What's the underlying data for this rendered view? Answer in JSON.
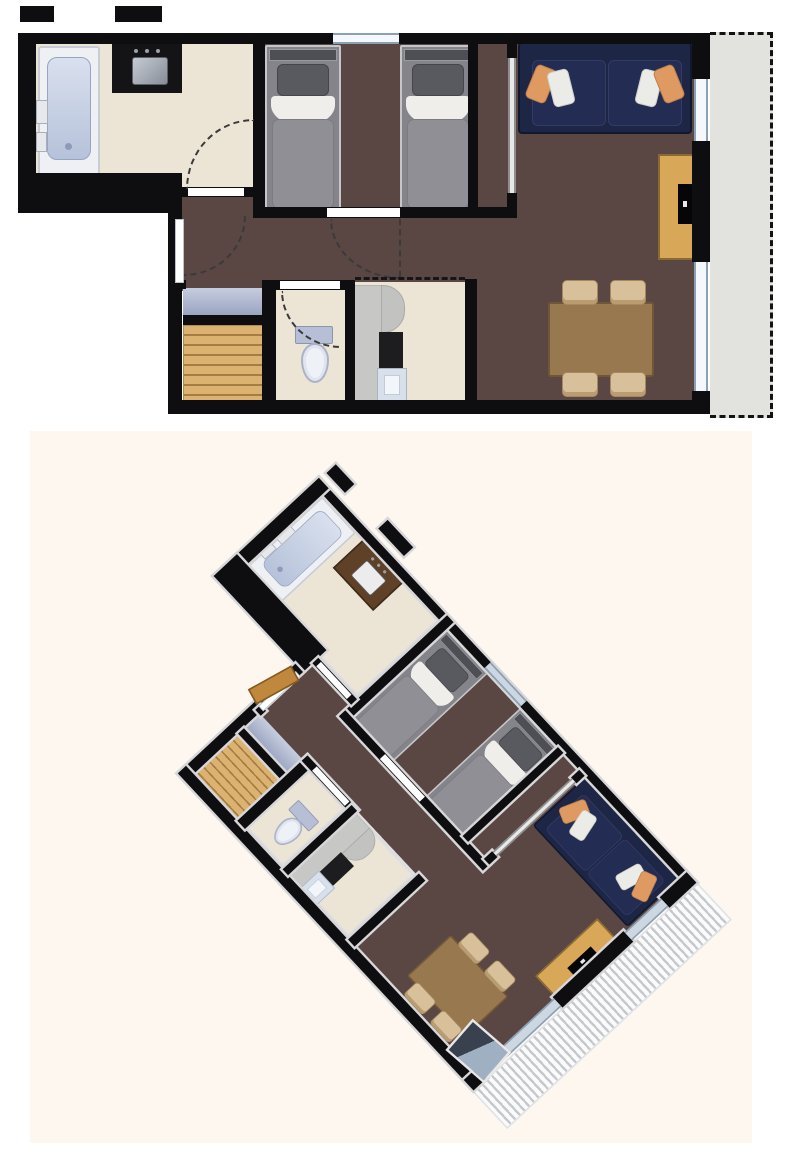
{
  "document": {
    "kind": "apartment floor plan, two views",
    "views": {
      "top": {
        "type": "2D top-down plan"
      },
      "bottom": {
        "type": "3D rotated dollhouse plan",
        "rotation_deg": 47,
        "background": "#fdf7ef",
        "balcony_finish": "white plank decking stripes"
      }
    }
  },
  "palette": {
    "background": "#ffffff",
    "backdrop3d": "#fdf7ef",
    "wall": "#0e0e10",
    "tile": "#ece5d6",
    "carpet": "#5a4743",
    "balcony": "#e2e2df",
    "mat": "#b0b9d2",
    "stairs_wood": "#dcb271",
    "entry_door_wood": "#c0883c",
    "sofa_navy": "#1e2646",
    "pillow_orange": "#df9a62",
    "pillow_white": "#ebebe8",
    "bed_duvet_gray": "#8f8f95",
    "bed_sheet_white": "#efeeea",
    "table_wood": "#98794f",
    "chair_beige": "#d8c09a",
    "sideboard_wood": "#d8a757",
    "tub_blue": "#c3cede",
    "vanity_black": "#141417",
    "window_frame": "#8aa0b4"
  },
  "rooms": {
    "bathroom": {
      "label": "Bathroom",
      "floor_material": "beige tile",
      "furniture": [
        "bathtub",
        "black vanity with sink"
      ],
      "features": [
        "door swing arc"
      ]
    },
    "bedroom": {
      "label": "Bedroom",
      "floor_material": "dark brown carpet",
      "furniture": [
        "single bed",
        "single bed"
      ],
      "features": [
        "window in top wall",
        "door to hallway"
      ]
    },
    "living_room": {
      "label": "Living room / dining",
      "floor_material": "dark brown carpet",
      "furniture": [
        "navy sofa with orange and white cushions",
        "wooden TV sideboard with TV",
        "wooden dining table",
        "4 beige chairs"
      ],
      "features": [
        "two windows to balcony",
        "glazed partition to bedroom nook"
      ]
    },
    "hallway": {
      "label": "Hallway",
      "floor_material": "dark brown carpet",
      "furniture": [],
      "features": [
        "apartment entry door with swing arc"
      ]
    },
    "entry": {
      "label": "Entry / stairs",
      "floor_material": "wood planks",
      "furniture": [
        "doormat",
        "wooden stairs"
      ],
      "features": []
    },
    "wc": {
      "label": "WC",
      "floor_material": "beige tile",
      "furniture": [
        "toilet"
      ],
      "features": [
        "door swing arc"
      ]
    },
    "kitchen": {
      "label": "Kitchen",
      "floor_material": "beige tile",
      "furniture": [
        "counter run",
        "black cooktop",
        "sink"
      ],
      "features": [
        "open side marked with dashed line"
      ]
    },
    "balcony": {
      "label": "Balcony",
      "floor_material": "concrete (2D) / plank decking (3D)",
      "furniture": [],
      "features": [
        "dashed railing outline"
      ]
    }
  }
}
